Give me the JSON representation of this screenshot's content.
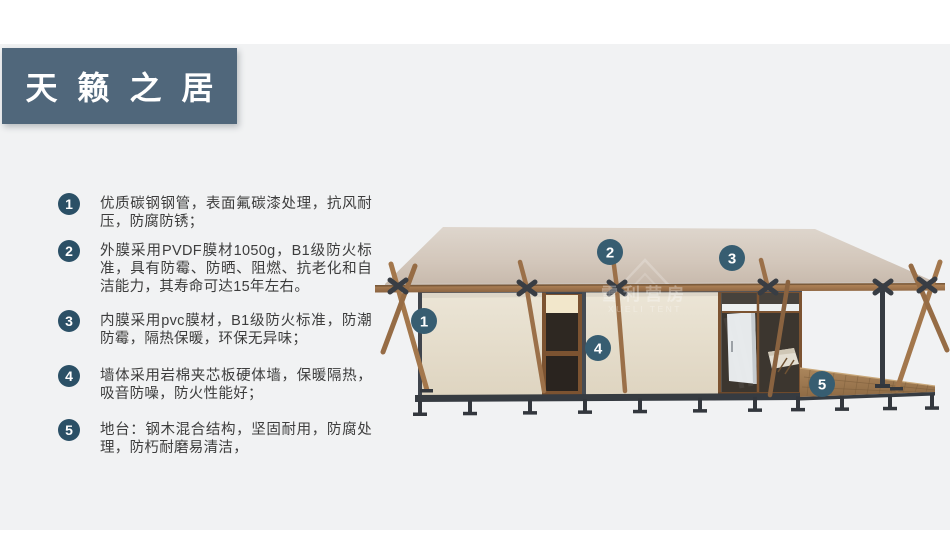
{
  "title": "天籁之居",
  "features": [
    {
      "num": "1",
      "text": "优质碳钢钢管，表面氟碳漆处理，抗风耐压，防腐防锈；"
    },
    {
      "num": "2",
      "text": "外膜采用PVDF膜材1050g，B1级防火标准，具有防霉、防晒、阻燃、抗老化和自洁能力，其寿命可达15年左右。"
    },
    {
      "num": "3",
      "text": "内膜采用pvc膜材，B1级防火标准，防潮防霉，隔热保暖，环保无异味；"
    },
    {
      "num": "4",
      "text": "墙体采用岩棉夹芯板硬体墙，保暖隔热，吸音防噪，防火性能好；"
    },
    {
      "num": "5",
      "text": "地台：钢木混合结构，坚固耐用，防腐处理，防朽耐磨易清洁，"
    }
  ],
  "diagram": {
    "markers": [
      {
        "num": "1"
      },
      {
        "num": "2"
      },
      {
        "num": "3"
      },
      {
        "num": "4"
      },
      {
        "num": "5"
      }
    ],
    "watermark": {
      "cn": "雪利营房",
      "en": "XUELI TENT"
    }
  },
  "colors": {
    "title_box": "#50677b",
    "list_badge": "#2b5066",
    "image_marker": "#375d71",
    "slide_background": "#f1f2f3",
    "roof": "#d3c7bb",
    "wall": "#e9e2d2",
    "wood": "#a3774c",
    "steel": "#383d44"
  }
}
